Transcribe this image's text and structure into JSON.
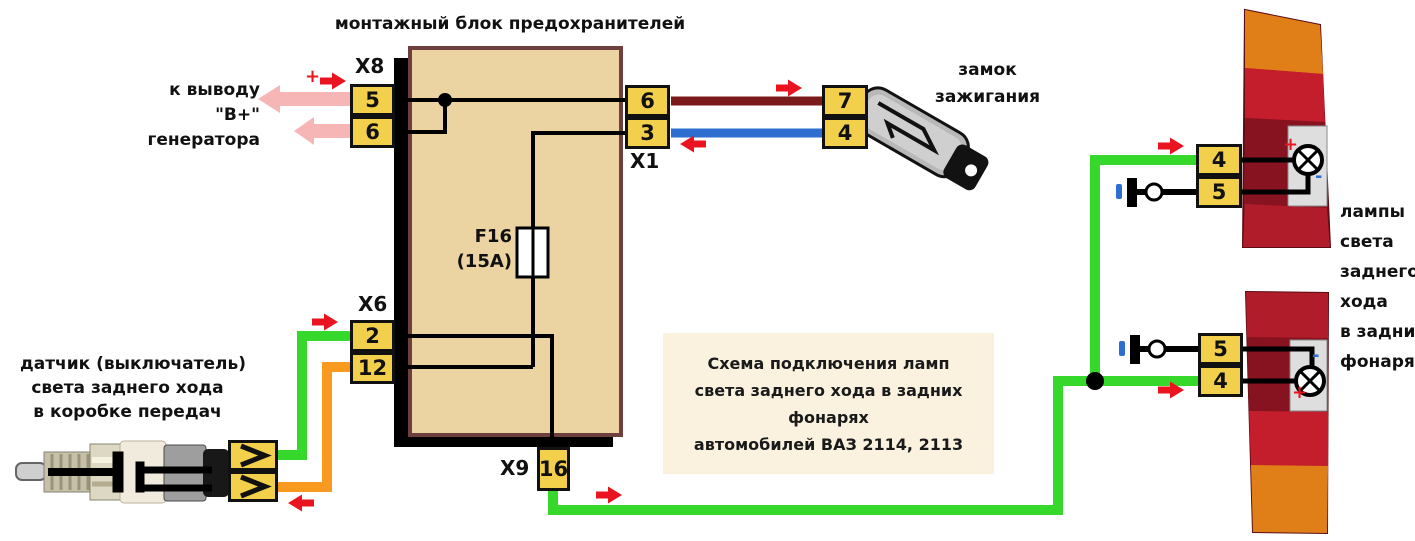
{
  "title": "монтажный блок предохранителей",
  "generator_label": {
    "line1": "к выводу",
    "line2": "\"В+\"",
    "line3": "генератора",
    "plus": "+"
  },
  "fuse": {
    "name": "F16",
    "rating": "(15А)"
  },
  "connectors": {
    "x8": {
      "label": "X8",
      "pins": [
        "5",
        "6"
      ]
    },
    "x6": {
      "label": "X6",
      "pins": [
        "2",
        "12"
      ]
    },
    "x1": {
      "label": "X1",
      "pins": [
        "6",
        "3"
      ]
    },
    "x9": {
      "label": "X9",
      "pins": [
        "16"
      ]
    },
    "ignition_plug": {
      "pins": [
        "7",
        "4"
      ]
    },
    "upper_lamp_plug": {
      "pins": [
        "4",
        "5"
      ]
    },
    "lower_lamp_plug": {
      "pins": [
        "5",
        "4"
      ]
    },
    "sensor_plug": {
      "pins": [
        "chevron",
        "chevron"
      ]
    }
  },
  "ignition_label": {
    "line1": "замок",
    "line2": "зажигания"
  },
  "sensor_label": {
    "line1": "датчик (выключатель)",
    "line2": "света заднего хода",
    "line3": "в коробке передач"
  },
  "note": {
    "line1": "Схема подключения ламп",
    "line2": "света заднего хода в задних фонарях",
    "line3": "автомобилей ВАЗ 2114, 2113"
  },
  "lamps_label": {
    "lines": [
      "лампы",
      "света",
      "заднего",
      "хода",
      "в задних",
      "фонарях"
    ]
  },
  "polarity": {
    "plus": "+",
    "minus": "-"
  },
  "colors": {
    "green_wire": "#35d82b",
    "orange_wire": "#f79a1f",
    "dark_red_wire": "#7b1a1a",
    "blue_wire": "#2e6ed0",
    "pink_arrow": "#f6b6b6",
    "red_arrow": "#ea1420",
    "connector_yellow": "#f2d04b",
    "block_fill": "#ebd3a2",
    "block_border": "#6e3f3f",
    "note_bg": "#faf1de"
  }
}
